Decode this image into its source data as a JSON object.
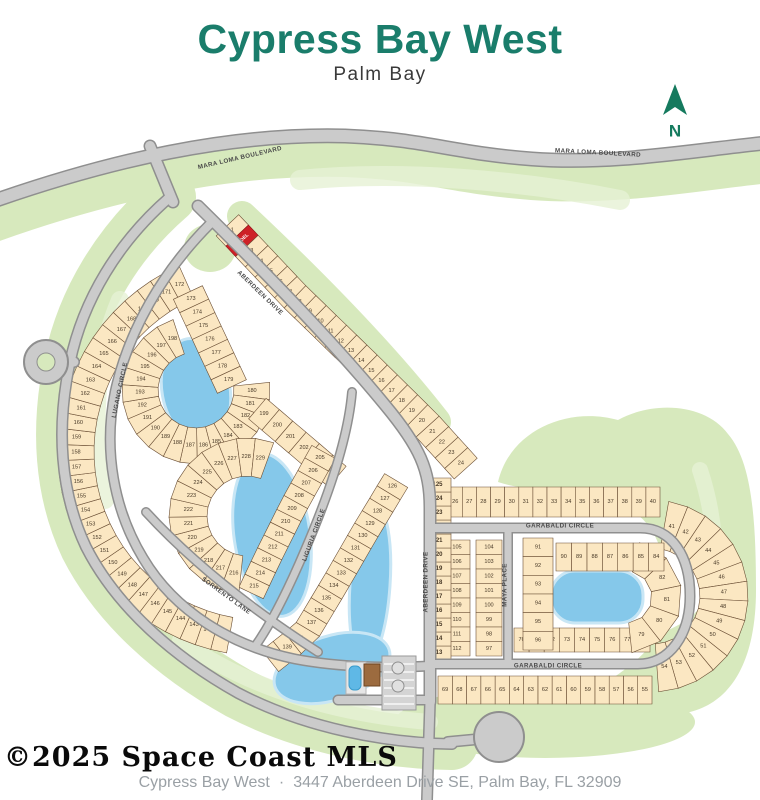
{
  "title": "Cypress Bay West",
  "subtitle": "Palm Bay",
  "compass": {
    "label": "N"
  },
  "watermark": "©2025 Space Coast MLS",
  "footer": {
    "name": "Cypress Bay West",
    "separator": "·",
    "address": "3447 Aberdeen Drive SE, Palm Bay, FL 32909"
  },
  "colors": {
    "title": "#1a7d6b",
    "compass_green": "#157a5e",
    "lot_fill": "#fbe7c2",
    "lot_stroke": "#6b4f35",
    "lot_text": "#473826",
    "model_fill": "#ce2127",
    "model_text": "#ffffff",
    "road_fill": "#cbcbcb",
    "road_edge": "#8f8f8f",
    "water": "#85c8ea",
    "water_edge": "#c8e6f5",
    "green": "#d7e9bd",
    "green_light": "#e6f1d4",
    "street_label": "#4a4a4a",
    "building": "#9c6b3f",
    "pool": "#5fb8e6"
  },
  "map": {
    "model_lot_label": "MODEL",
    "streets": [
      {
        "id": "mara-loma",
        "label": "MARA LOMA BOULEVARD"
      },
      {
        "id": "aberdeen-drive",
        "label": "ABERDEEN DRIVE"
      },
      {
        "id": "garabaldi-circle",
        "label": "GARABALDI CIRCLE"
      },
      {
        "id": "maya-place",
        "label": "MAYA PLACE"
      },
      {
        "id": "lugano-circle",
        "label": "LUGANO CIRCLE"
      },
      {
        "id": "liguria-circle",
        "label": "LIGURIA CIRCLE"
      },
      {
        "id": "sorrento-lane",
        "label": "SORRENTO LANE"
      }
    ],
    "strips": [
      {
        "id": "entry-east",
        "lots": [
          "1",
          "MODEL",
          "3",
          "4",
          "5",
          "6",
          "7",
          "8",
          "9",
          "10",
          "11",
          "12",
          "13",
          "14",
          "15",
          "16",
          "17",
          "18",
          "19",
          "20",
          "21",
          "22",
          "23",
          "24"
        ]
      },
      {
        "id": "garabaldi-north",
        "lots": [
          "25",
          "26",
          "27",
          "28",
          "29",
          "30",
          "31",
          "32",
          "33",
          "34",
          "35",
          "36",
          "37",
          "38",
          "39",
          "40"
        ]
      },
      {
        "id": "garabaldi-east-fan",
        "lots": [
          "41",
          "42",
          "43",
          "44",
          "45",
          "46",
          "47",
          "48",
          "49",
          "50",
          "51",
          "52",
          "53",
          "54"
        ]
      },
      {
        "id": "garabaldi-south",
        "lots": [
          "55",
          "56",
          "57",
          "58",
          "59",
          "60",
          "61",
          "62",
          "63",
          "64",
          "65",
          "66",
          "67",
          "68",
          "69"
        ]
      },
      {
        "id": "island-south",
        "lots": [
          "70",
          "71",
          "72",
          "73",
          "74",
          "75",
          "76",
          "77",
          "78"
        ]
      },
      {
        "id": "island-east-fan",
        "lots": [
          "79",
          "80",
          "81",
          "82",
          "83"
        ]
      },
      {
        "id": "island-top",
        "lots": [
          "84",
          "85",
          "86",
          "87",
          "88",
          "89",
          "90"
        ]
      },
      {
        "id": "island-left",
        "lots": [
          "91",
          "92",
          "93",
          "94",
          "95",
          "96"
        ]
      },
      {
        "id": "maya-east-col",
        "lots": [
          "104",
          "103",
          "102",
          "101",
          "100",
          "99",
          "98",
          "97"
        ]
      },
      {
        "id": "maya-west-col",
        "lots": [
          "105",
          "106",
          "107",
          "108",
          "109",
          "110",
          "111",
          "112"
        ]
      },
      {
        "id": "aberdeen-col",
        "bold": true,
        "lots": [
          "113",
          "114",
          "115",
          "116",
          "117",
          "118",
          "119",
          "120",
          "121",
          "122",
          "123",
          "124",
          "125"
        ]
      },
      {
        "id": "liguria-east",
        "lots": [
          "126",
          "127",
          "128",
          "129",
          "130",
          "131",
          "132",
          "133",
          "134",
          "135",
          "136",
          "137",
          "138",
          "139",
          "140"
        ]
      },
      {
        "id": "outer-crescent",
        "lots": [
          "141",
          "142",
          "143",
          "144",
          "145",
          "146",
          "147",
          "148",
          "149",
          "150",
          "151",
          "152",
          "153",
          "154",
          "155",
          "156",
          "157",
          "158",
          "159",
          "160",
          "161",
          "162",
          "163",
          "164",
          "165",
          "166",
          "167",
          "168",
          "169",
          "170",
          "171",
          "172"
        ]
      },
      {
        "id": "entry-west",
        "lots": [
          "173",
          "174",
          "175",
          "176",
          "177",
          "178",
          "179"
        ]
      },
      {
        "id": "lake-ring",
        "lots": [
          "180",
          "181",
          "182",
          "183",
          "184",
          "185",
          "186",
          "187",
          "188",
          "189",
          "190",
          "191",
          "192",
          "193",
          "194",
          "195",
          "196",
          "197",
          "198"
        ]
      },
      {
        "id": "aberdeen-sw",
        "lots": [
          "199",
          "200",
          "201",
          "202",
          "203",
          "204"
        ]
      },
      {
        "id": "liguria-west",
        "lots": [
          "205",
          "206",
          "207",
          "208",
          "209",
          "210",
          "211",
          "212",
          "213",
          "214",
          "215"
        ]
      },
      {
        "id": "inner-wedge",
        "lots": [
          "216",
          "217",
          "218",
          "219",
          "220",
          "221",
          "222",
          "223",
          "224",
          "225",
          "226",
          "227",
          "228",
          "229"
        ]
      }
    ]
  }
}
